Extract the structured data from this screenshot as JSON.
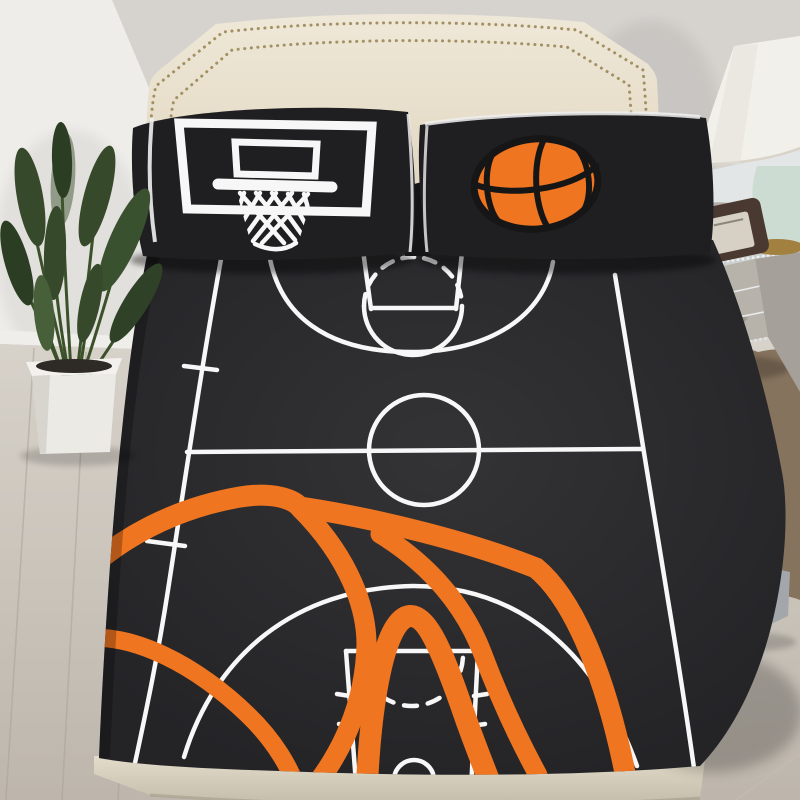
{
  "scene": {
    "type": "product-photo",
    "subject": "basketball-court black bedding set on a bed",
    "objects": [
      {
        "name": "upholstered-headboard",
        "detail": "cream headboard with double gold nailhead trim"
      },
      {
        "name": "pillow-left",
        "detail": "black pillowcase with white basketball backboard, rim and net graphic"
      },
      {
        "name": "pillow-right",
        "detail": "black pillowcase with orange basketball graphic"
      },
      {
        "name": "fitted-sheet",
        "detail": "black sheet printed with white basketball court lines and a large orange basketball outline"
      },
      {
        "name": "potted-plant",
        "detail": "bird-of-paradise plant in white square planter"
      },
      {
        "name": "mirrored-nightstand",
        "detail": "three-drawer mirrored chest with crystal knobs and beaded trim"
      },
      {
        "name": "table-lamp",
        "detail": "white shade, celadon glass base with brass ring"
      },
      {
        "name": "vintage-radio",
        "detail": "small brown radio with cream front panel and wire handle"
      },
      {
        "name": "fur-rug",
        "detail": "brown shaggy sheepskin rug"
      },
      {
        "name": "folded-stool",
        "detail": "gray folded item with two tan straps on floor"
      },
      {
        "name": "bed-frame",
        "detail": "beige platform frame under mattress"
      }
    ],
    "counts": {
      "pillows": 2,
      "nightstand_drawers": 3,
      "nailhead_rows": 2
    }
  },
  "palette": {
    "wall": "#d6d3cf",
    "column": "#efede9",
    "columnEdge": "#dedbd6",
    "baseboard": "#f0eeea",
    "floor": "#d3cec6",
    "plank": "#aaa398",
    "tileLine": "#c4bdb3",
    "rug": "#86735d",
    "rugDark": "#6a5946",
    "headboard": "#e9e1d0",
    "nailhead": "#9a8756",
    "pillow": "#1f1f21",
    "piping": "#efefef",
    "sheet": "#242427",
    "courtLine": "#f7f7f7",
    "orange": "#ef7520",
    "ballSeam": "#161616",
    "frame": "#d9d2c1",
    "pot": "#eceae5",
    "potRim": "#f3f1ed",
    "soil": "#2e2a26",
    "leaf": "#36492b",
    "leafLight": "#47603a",
    "stem": "#3a5129",
    "mirrorTop": "#e3e6e6",
    "mirrorFace": "#b7b3ab",
    "mirrorSide": "#a5a19a",
    "beadTrim": "#cdd0d0",
    "knob": "#eceff0",
    "lampShade": "#f2f0eb",
    "lampBase": "#cddcd2",
    "brass": "#a28040",
    "radioBody": "#4a3930",
    "radioPanel": "#d7d1c5",
    "stoolBody": "#a3a7ab",
    "stoolTop": "#c0c4c8",
    "strap": "#b5773f"
  }
}
